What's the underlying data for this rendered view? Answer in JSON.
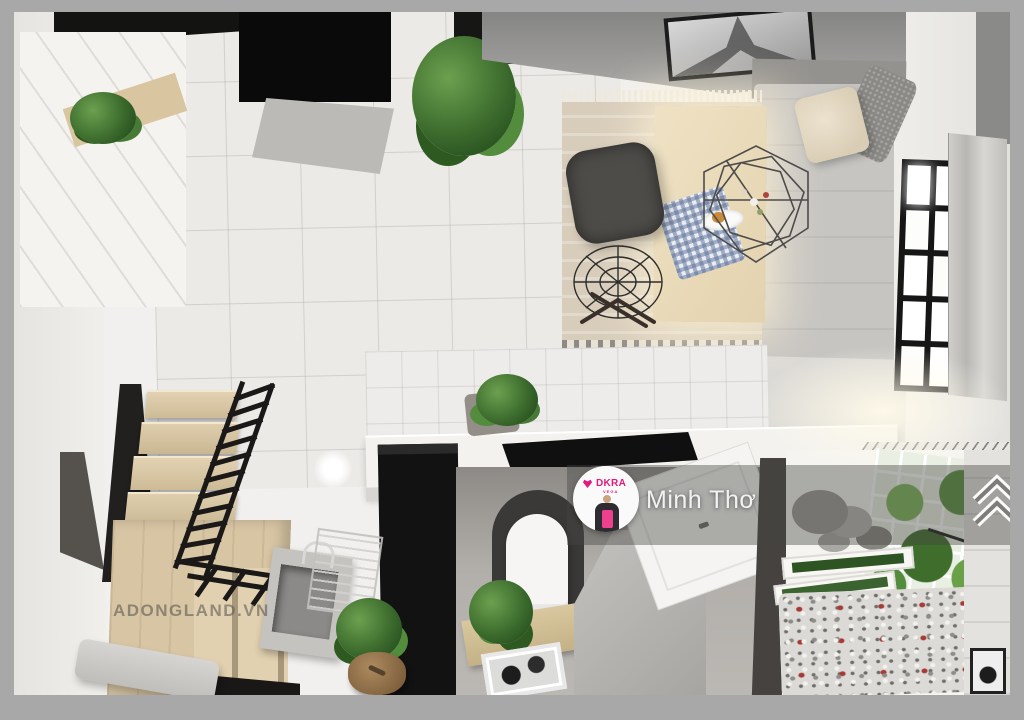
{
  "scene": {
    "type": "3d-apartment-top-down-render",
    "rooms": [
      "living-dining",
      "bedroom-corner",
      "kitchen",
      "bathroom",
      "loft-stairs",
      "balcony-garden"
    ]
  },
  "overlay": {
    "watermark": "ADONGLAND.VN",
    "agent_name": "Minh Thơ",
    "brand": "DKRA",
    "brand_sub": "VEGA"
  },
  "icons": {
    "chevron": "double-chevron-up-icon",
    "avatar": "agent-avatar",
    "brand_logo": "dkra-heart-logo-icon"
  },
  "colors": {
    "brand_magenta": "#e4187f",
    "frame_grey": "#a8a8a8",
    "name_text": "#f2f2f2",
    "watermark_text": "#5f5c57",
    "overlay_band": "rgba(70,68,66,0.42)"
  }
}
